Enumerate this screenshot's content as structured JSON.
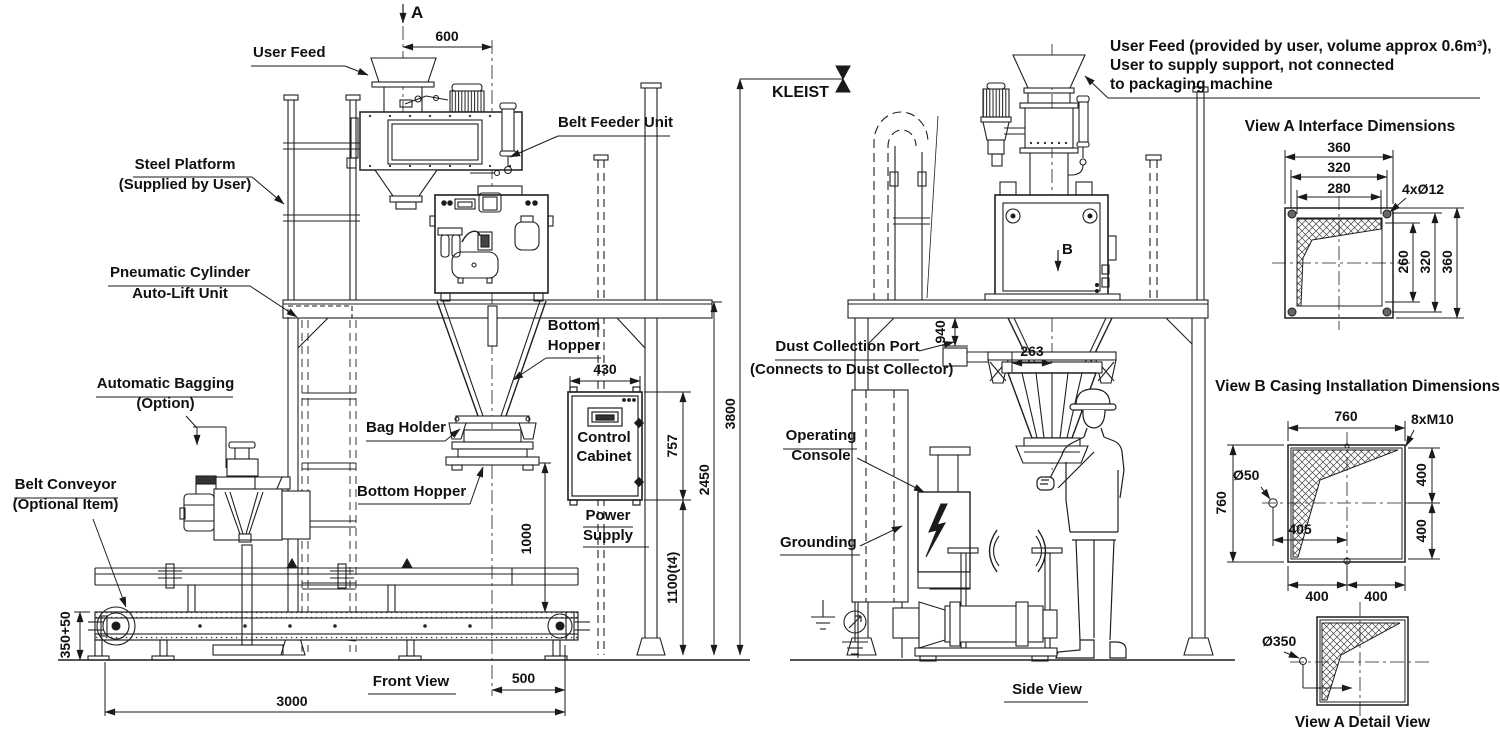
{
  "front_view": {
    "caption": "Front View",
    "section_marker_a": "A",
    "elevation_marker": "KLEIST",
    "labels": {
      "user_feed": "User Feed",
      "steel_platform_1": "Steel Platform",
      "steel_platform_2": "(Supplied by User)",
      "pneumatic_cylinder_1": "Pneumatic Cylinder",
      "pneumatic_cylinder_2": "Auto-Lift Unit",
      "automatic_bagging_1": "Automatic Bagging",
      "automatic_bagging_2": "(Option)",
      "belt_conveyor_1": "Belt Conveyor",
      "belt_conveyor_2": "(Optional Item)",
      "belt_feeder_unit": "Belt Feeder Unit",
      "bottom_hopper_upper_1": "Bottom",
      "bottom_hopper_upper_2": "Hopper",
      "bag_holder": "Bag Holder",
      "bottom_hopper_lower": "Bottom Hopper",
      "control_cabinet_1": "Control",
      "control_cabinet_2": "Cabinet",
      "power_supply_1": "Power",
      "power_supply_2": "Supply"
    },
    "dimensions": {
      "hopper_width": "600",
      "cabinet_width": "430",
      "cabinet_height": "757",
      "cabinet_floor_clearance": "1100(t4)",
      "platform_height": "2450",
      "total_height": "3800",
      "bag_clearance": "1000",
      "conveyor_height": "350+50",
      "conveyor_length": "3000",
      "discharge_offset": "500"
    }
  },
  "side_view": {
    "caption": "Side View",
    "section_marker_b": "B",
    "labels": {
      "dust_port_1": "Dust Collection Port",
      "dust_port_2": "(Connects to Dust Collector)",
      "operating_console_1": "Operating",
      "operating_console_2": "Console",
      "grounding": "Grounding"
    },
    "dimensions": {
      "dust_port_drop": "940",
      "hopper_offset": "263"
    }
  },
  "notes": {
    "user_feed_note_1": "User Feed (provided by user, volume approx 0.6m³),",
    "user_feed_note_2": "User to supply support, not connected",
    "user_feed_note_3": "to packaging machine"
  },
  "view_a": {
    "title": "View A Interface Dimensions",
    "dims": {
      "outer_width": "360",
      "bolt_spacing_h": "320",
      "opening_width": "280",
      "bolt_holes": "4xØ12",
      "opening_height": "260",
      "bolt_spacing_v": "320",
      "outer_height": "360"
    }
  },
  "view_b": {
    "title": "View B Casing Installation Dimensions",
    "dims": {
      "top_width": "760",
      "bolt_holes": "8xM10",
      "hole_dia": "Ø50",
      "hole_offset": "405",
      "left_height": "760",
      "right_upper": "400",
      "right_lower": "400",
      "bottom_left": "400",
      "bottom_right": "400"
    }
  },
  "view_a_detail": {
    "title": "View A Detail View",
    "dims": {
      "port_dia": "Ø350"
    }
  }
}
